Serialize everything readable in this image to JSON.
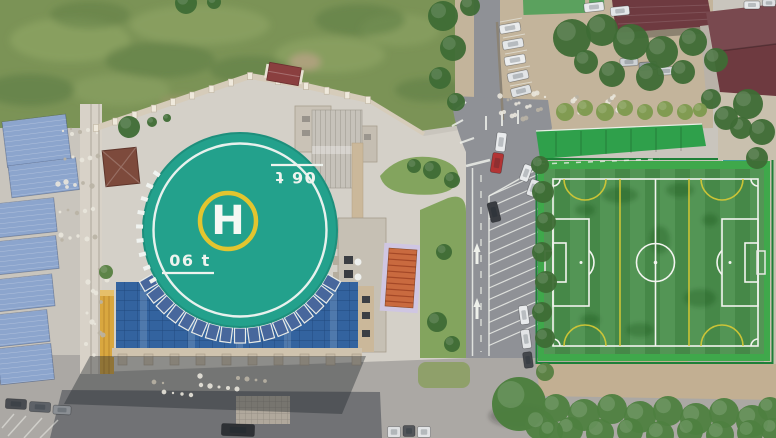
{
  "helipad": {
    "letter": "H",
    "mass_marking": "06 t",
    "center": {
      "x": 240,
      "y": 230
    },
    "radius": 96,
    "panel_arc": {
      "start": 30,
      "end": 150,
      "step": 7.5
    },
    "dash_arc": {
      "start": 150,
      "end": 214,
      "step": 8
    }
  },
  "colors": {
    "concrete_base": "#c9c5bd",
    "plaza": "#aba8a4",
    "asphalt_dark": "#717275",
    "asphalt": "#8f9196",
    "wild_grass": "#7b9356",
    "lawn": "#83a45e",
    "dirt": "#c3b49b",
    "dirt_south": "#c2af92",
    "courtyard": "#d4d0c8",
    "helipad_surface": "#23a18c",
    "helipad_ring": "#f2f6f2",
    "helipad_circle_yellow": "#e2c52f",
    "glass_roof": "#33639f",
    "shed_blue": "#8ca5cd",
    "maroon_roof": "#6e3a40",
    "green_canopy": "#2fa04b",
    "turf": "#4a8f4c",
    "turf_apron": "#3fa84b",
    "line_white": "#f2f4ef",
    "line_yellow": "#d9ca35",
    "tree": "#3e6b35",
    "bush": "#4e8040",
    "weed": "#7d9a4e",
    "amber_strip": "#d9a73f",
    "wall_tan": "#d6ccba",
    "pavilion_roof": "#7d4a3c",
    "orange_mat": "#c96a3f",
    "red_car": "#b23434"
  },
  "parking_hatch": {
    "x1": 489,
    "x2": 539,
    "y1": 196,
    "y2": 356,
    "step": 11.5,
    "rise": 22
  },
  "teeth": {
    "x1": 118,
    "x2": 352,
    "step": 26,
    "y": 354,
    "w": 9,
    "h": 11
  },
  "wall": {
    "points": [
      [
        96,
        128
      ],
      [
        250,
        76
      ],
      [
        306,
        86
      ],
      [
        368,
        100
      ]
    ],
    "spacing": 20
  },
  "cars": [
    {
      "x": 510,
      "y": 28,
      "w": 21,
      "h": 9,
      "r": -10,
      "c": "#e9ebec"
    },
    {
      "x": 513,
      "y": 44,
      "w": 21,
      "h": 9,
      "r": -10,
      "c": "#e4e7e9"
    },
    {
      "x": 515,
      "y": 60,
      "w": 21,
      "h": 9,
      "r": -10,
      "c": "#eceeef"
    },
    {
      "x": 518,
      "y": 76,
      "w": 21,
      "h": 9,
      "r": -12,
      "c": "#e2e5e7"
    },
    {
      "x": 521,
      "y": 91,
      "w": 20,
      "h": 9,
      "r": -14,
      "c": "#dfe2e4"
    },
    {
      "x": 594,
      "y": 7,
      "w": 20,
      "h": 9,
      "r": -6,
      "c": "#e8eaec"
    },
    {
      "x": 620,
      "y": 11,
      "w": 19,
      "h": 9,
      "r": -6,
      "c": "#e3e6e8"
    },
    {
      "x": 629,
      "y": 62,
      "w": 18,
      "h": 8,
      "r": -3,
      "c": "#cdd1d4"
    },
    {
      "x": 648,
      "y": 66,
      "w": 18,
      "h": 8,
      "r": -3,
      "c": "#9aa0a5"
    },
    {
      "x": 666,
      "y": 71,
      "w": 17,
      "h": 8,
      "r": -3,
      "c": "#d5d8da"
    },
    {
      "x": 752,
      "y": 5,
      "w": 16,
      "h": 8,
      "r": 0,
      "c": "#e6e8ea"
    },
    {
      "x": 769,
      "y": 3,
      "w": 13,
      "h": 7,
      "r": 0,
      "c": "#dde0e2"
    },
    {
      "x": 501,
      "y": 142,
      "w": 10,
      "h": 19,
      "r": 7,
      "c": "#e9ebed"
    },
    {
      "x": 497,
      "y": 163,
      "w": 11,
      "h": 20,
      "r": 9,
      "c": "#b23434"
    },
    {
      "x": 526,
      "y": 173,
      "w": 9,
      "h": 17,
      "r": 20,
      "c": "#e8eaec"
    },
    {
      "x": 533,
      "y": 188,
      "w": 9,
      "h": 17,
      "r": 20,
      "c": "#e3e5e7"
    },
    {
      "x": 494,
      "y": 212,
      "w": 10,
      "h": 20,
      "r": -14,
      "c": "#393c41"
    },
    {
      "x": 524,
      "y": 315,
      "w": 9,
      "h": 19,
      "r": -8,
      "c": "#e8eaec"
    },
    {
      "x": 526,
      "y": 339,
      "w": 9,
      "h": 19,
      "r": -8,
      "c": "#e2e4e6"
    },
    {
      "x": 528,
      "y": 360,
      "w": 9,
      "h": 16,
      "r": -8,
      "c": "#44474c"
    },
    {
      "x": 238,
      "y": 430,
      "w": 33,
      "h": 12,
      "r": 2,
      "c": "#2e3135"
    },
    {
      "x": 394,
      "y": 432,
      "w": 13,
      "h": 11,
      "r": 0,
      "c": "#dee0e2"
    },
    {
      "x": 409,
      "y": 431,
      "w": 12,
      "h": 11,
      "r": 0,
      "c": "#53565a"
    },
    {
      "x": 424,
      "y": 432,
      "w": 13,
      "h": 11,
      "r": 0,
      "c": "#e2e4e6"
    },
    {
      "x": 16,
      "y": 404,
      "w": 21,
      "h": 10,
      "r": 3,
      "c": "#494c51"
    },
    {
      "x": 40,
      "y": 407,
      "w": 21,
      "h": 10,
      "r": 3,
      "c": "#5e6268"
    },
    {
      "x": 62,
      "y": 410,
      "w": 18,
      "h": 9,
      "r": 3,
      "c": "#8b8f94"
    }
  ],
  "trees": [
    {
      "x": 572,
      "y": 38,
      "r": 19
    },
    {
      "x": 602,
      "y": 30,
      "r": 16
    },
    {
      "x": 631,
      "y": 42,
      "r": 18
    },
    {
      "x": 662,
      "y": 52,
      "r": 16
    },
    {
      "x": 693,
      "y": 42,
      "r": 14
    },
    {
      "x": 612,
      "y": 74,
      "r": 13
    },
    {
      "x": 650,
      "y": 77,
      "r": 14
    },
    {
      "x": 683,
      "y": 72,
      "r": 12
    },
    {
      "x": 716,
      "y": 60,
      "r": 12
    },
    {
      "x": 586,
      "y": 62,
      "r": 12
    },
    {
      "x": 748,
      "y": 104,
      "r": 15
    },
    {
      "x": 762,
      "y": 132,
      "r": 13
    },
    {
      "x": 741,
      "y": 128,
      "r": 11
    },
    {
      "x": 757,
      "y": 158,
      "r": 11
    },
    {
      "x": 726,
      "y": 118,
      "r": 12
    },
    {
      "x": 711,
      "y": 99,
      "r": 10
    },
    {
      "x": 443,
      "y": 16,
      "r": 15
    },
    {
      "x": 453,
      "y": 48,
      "r": 13
    },
    {
      "x": 440,
      "y": 78,
      "r": 11
    },
    {
      "x": 456,
      "y": 102,
      "r": 9
    },
    {
      "x": 470,
      "y": 6,
      "r": 10
    },
    {
      "x": 543,
      "y": 192,
      "r": 11
    },
    {
      "x": 546,
      "y": 222,
      "r": 10
    },
    {
      "x": 542,
      "y": 252,
      "r": 10
    },
    {
      "x": 546,
      "y": 282,
      "r": 11
    },
    {
      "x": 542,
      "y": 312,
      "r": 10
    },
    {
      "x": 545,
      "y": 338,
      "r": 10
    },
    {
      "x": 540,
      "y": 165,
      "r": 9
    },
    {
      "x": 519,
      "y": 404,
      "r": 27,
      "c": "#4a7d3c"
    },
    {
      "x": 540,
      "y": 425,
      "r": 15,
      "c": "#4e8040"
    },
    {
      "x": 432,
      "y": 170,
      "r": 9
    },
    {
      "x": 452,
      "y": 180,
      "r": 8
    },
    {
      "x": 414,
      "y": 166,
      "r": 7
    },
    {
      "x": 444,
      "y": 252,
      "r": 8
    },
    {
      "x": 437,
      "y": 322,
      "r": 10
    },
    {
      "x": 452,
      "y": 344,
      "r": 8
    },
    {
      "x": 129,
      "y": 127,
      "r": 11
    },
    {
      "x": 152,
      "y": 122,
      "r": 5
    },
    {
      "x": 167,
      "y": 118,
      "r": 4
    },
    {
      "x": 186,
      "y": 3,
      "r": 11
    },
    {
      "x": 214,
      "y": 2,
      "r": 7
    },
    {
      "x": 106,
      "y": 272,
      "r": 7,
      "c": "#567f41"
    },
    {
      "x": 545,
      "y": 372,
      "r": 9,
      "c": "#567f41"
    },
    {
      "x": 565,
      "y": 112,
      "r": 9,
      "n": "weeds",
      "c": "#7d9a4e"
    },
    {
      "x": 585,
      "y": 108,
      "r": 8,
      "n": "weeds",
      "c": "#7d9a4e"
    },
    {
      "x": 605,
      "y": 112,
      "r": 9,
      "n": "weeds",
      "c": "#7d9a4e"
    },
    {
      "x": 625,
      "y": 108,
      "r": 8,
      "n": "weeds",
      "c": "#7d9a4e"
    },
    {
      "x": 645,
      "y": 112,
      "r": 8,
      "n": "weeds",
      "c": "#7d9a4e"
    },
    {
      "x": 665,
      "y": 109,
      "r": 8,
      "n": "weeds",
      "c": "#7d9a4e"
    },
    {
      "x": 685,
      "y": 112,
      "r": 8,
      "n": "weeds",
      "c": "#7d9a4e"
    },
    {
      "x": 700,
      "y": 110,
      "r": 7,
      "n": "weeds",
      "c": "#7d9a4e"
    },
    {
      "x": 556,
      "y": 408,
      "r": 14,
      "n": "bush",
      "c": "#4e8040"
    },
    {
      "x": 584,
      "y": 415,
      "r": 16,
      "n": "bush",
      "c": "#4e8040"
    },
    {
      "x": 612,
      "y": 409,
      "r": 15,
      "n": "bush",
      "c": "#4e8040"
    },
    {
      "x": 640,
      "y": 417,
      "r": 16,
      "n": "bush",
      "c": "#4e8040"
    },
    {
      "x": 668,
      "y": 411,
      "r": 15,
      "n": "bush",
      "c": "#4e8040"
    },
    {
      "x": 696,
      "y": 419,
      "r": 16,
      "n": "bush",
      "c": "#4e8040"
    },
    {
      "x": 724,
      "y": 413,
      "r": 15,
      "n": "bush",
      "c": "#4e8040"
    },
    {
      "x": 752,
      "y": 421,
      "r": 16,
      "n": "bush",
      "c": "#4e8040"
    },
    {
      "x": 770,
      "y": 409,
      "r": 12,
      "n": "bush",
      "c": "#4e8040"
    },
    {
      "x": 570,
      "y": 430,
      "r": 13,
      "n": "bush",
      "c": "#4e8040"
    },
    {
      "x": 600,
      "y": 433,
      "r": 14,
      "n": "bush",
      "c": "#4e8040"
    },
    {
      "x": 630,
      "y": 431,
      "r": 13,
      "n": "bush",
      "c": "#4e8040"
    },
    {
      "x": 660,
      "y": 435,
      "r": 14,
      "n": "bush",
      "c": "#4e8040"
    },
    {
      "x": 690,
      "y": 431,
      "r": 13,
      "n": "bush",
      "c": "#4e8040"
    },
    {
      "x": 720,
      "y": 435,
      "r": 14,
      "n": "bush",
      "c": "#4e8040"
    },
    {
      "x": 750,
      "y": 433,
      "r": 13,
      "n": "bush",
      "c": "#4e8040"
    },
    {
      "x": 773,
      "y": 430,
      "r": 12,
      "n": "bush",
      "c": "#4e8040"
    },
    {
      "x": 551,
      "y": 432,
      "r": 12,
      "n": "bush",
      "c": "#4e8040"
    }
  ],
  "rubble": [
    {
      "x": 58,
      "y": 122,
      "w": 42,
      "h": 132,
      "n": 28
    },
    {
      "x": 498,
      "y": 92,
      "w": 48,
      "h": 28,
      "n": 18
    },
    {
      "x": 558,
      "y": 96,
      "w": 72,
      "h": 18,
      "n": 15
    },
    {
      "x": 86,
      "y": 262,
      "w": 22,
      "h": 95,
      "n": 14
    },
    {
      "x": 150,
      "y": 376,
      "w": 120,
      "h": 20,
      "n": 16
    }
  ]
}
